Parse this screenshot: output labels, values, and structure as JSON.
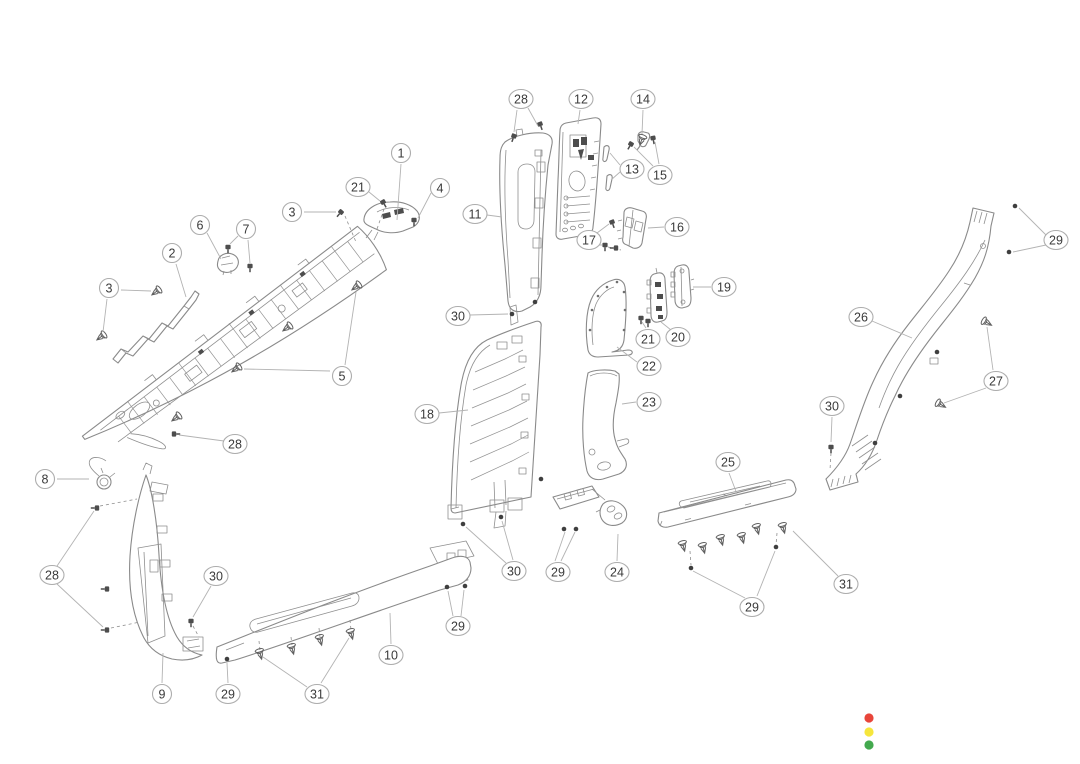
{
  "figure": {
    "background": "#ffffff",
    "line": "#8a8a8a",
    "leader": "#b3b3b3",
    "callout_fill": "#ffffff",
    "callout_stroke": "#adadad",
    "callout_text": "#3a3a3a"
  },
  "callouts": [
    {
      "label": "1",
      "x": 401,
      "y": 153,
      "leaders": [
        [
          [
            401,
            164
          ],
          [
            397,
            220
          ]
        ]
      ]
    },
    {
      "label": "21",
      "x": 358,
      "y": 187,
      "leaders": [
        [
          [
            369,
            192
          ],
          [
            380,
            201
          ]
        ]
      ]
    },
    {
      "label": "4",
      "x": 440,
      "y": 188,
      "leaders": [
        [
          [
            431,
            193
          ],
          [
            418,
            218
          ]
        ]
      ]
    },
    {
      "label": "3",
      "x": 292,
      "y": 212,
      "leaders": [
        [
          [
            304,
            212
          ],
          [
            336,
            212
          ]
        ]
      ]
    },
    {
      "label": "6",
      "x": 200,
      "y": 225,
      "leaders": [
        [
          [
            207,
            233
          ],
          [
            221,
            259
          ]
        ]
      ]
    },
    {
      "label": "7",
      "x": 246,
      "y": 229,
      "leaders": [
        [
          [
            238,
            236
          ],
          [
            230,
            244
          ]
        ],
        [
          [
            248,
            240
          ],
          [
            250,
            263
          ]
        ]
      ]
    },
    {
      "label": "2",
      "x": 172,
      "y": 253,
      "leaders": [
        [
          [
            176,
            264
          ],
          [
            186,
            297
          ]
        ]
      ]
    },
    {
      "label": "3",
      "x": 109,
      "y": 288,
      "leaders": [
        [
          [
            121,
            290
          ],
          [
            151,
            291
          ]
        ],
        [
          [
            107,
            299
          ],
          [
            103,
            332
          ]
        ]
      ]
    },
    {
      "label": "5",
      "x": 342,
      "y": 376,
      "leaders": [
        [
          [
            345,
            365
          ],
          [
            356,
            292
          ]
        ],
        [
          [
            330,
            371
          ],
          [
            244,
            369
          ]
        ]
      ]
    },
    {
      "label": "28",
      "x": 235,
      "y": 444,
      "leaders": [
        [
          [
            224,
            441
          ],
          [
            179,
            435
          ]
        ]
      ]
    },
    {
      "label": "8",
      "x": 45,
      "y": 479,
      "leaders": [
        [
          [
            57,
            479
          ],
          [
            89,
            479
          ]
        ]
      ]
    },
    {
      "label": "28",
      "x": 52,
      "y": 575,
      "leaders": [
        [
          [
            57,
            566
          ],
          [
            94,
            511
          ]
        ],
        [
          [
            57,
            584
          ],
          [
            103,
            627
          ]
        ]
      ]
    },
    {
      "label": "30",
      "x": 216,
      "y": 576,
      "leaders": [
        [
          [
            211,
            586
          ],
          [
            193,
            617
          ]
        ]
      ]
    },
    {
      "label": "9",
      "x": 162,
      "y": 694,
      "leaders": [
        [
          [
            162,
            683
          ],
          [
            163,
            653
          ]
        ]
      ]
    },
    {
      "label": "29",
      "x": 228,
      "y": 694,
      "leaders": [
        [
          [
            228,
            683
          ],
          [
            227,
            663
          ]
        ]
      ]
    },
    {
      "label": "31",
      "x": 317,
      "y": 694,
      "leaders": [
        [
          [
            307,
            687
          ],
          [
            263,
            657
          ]
        ],
        [
          [
            321,
            683
          ],
          [
            349,
            638
          ]
        ]
      ]
    },
    {
      "label": "10",
      "x": 391,
      "y": 655,
      "leaders": [
        [
          [
            391,
            644
          ],
          [
            390,
            613
          ]
        ]
      ]
    },
    {
      "label": "29",
      "x": 458,
      "y": 626,
      "leaders": [
        [
          [
            453,
            616
          ],
          [
            448,
            591
          ]
        ],
        [
          [
            461,
            616
          ],
          [
            464,
            590
          ]
        ]
      ]
    },
    {
      "label": "28",
      "x": 521,
      "y": 99,
      "leaders": [
        [
          [
            517,
            110
          ],
          [
            514,
            132
          ]
        ],
        [
          [
            528,
            108
          ],
          [
            538,
            126
          ]
        ]
      ]
    },
    {
      "label": "12",
      "x": 581,
      "y": 99,
      "leaders": [
        [
          [
            580,
            110
          ],
          [
            578,
            124
          ]
        ]
      ]
    },
    {
      "label": "14",
      "x": 643,
      "y": 99,
      "leaders": [
        [
          [
            643,
            110
          ],
          [
            642,
            134
          ]
        ]
      ]
    },
    {
      "label": "13",
      "x": 632,
      "y": 169,
      "leaders": [
        [
          [
            620,
            165
          ],
          [
            610,
            153
          ]
        ],
        [
          [
            620,
            172
          ],
          [
            611,
            180
          ]
        ]
      ]
    },
    {
      "label": "15",
      "x": 660,
      "y": 175,
      "leaders": [
        [
          [
            653,
            166
          ],
          [
            634,
            147
          ]
        ],
        [
          [
            659,
            164
          ],
          [
            655,
            142
          ]
        ]
      ]
    },
    {
      "label": "11",
      "x": 475,
      "y": 214,
      "leaders": [
        [
          [
            487,
            215
          ],
          [
            502,
            217
          ]
        ]
      ]
    },
    {
      "label": "17",
      "x": 589,
      "y": 240,
      "leaders": [
        [
          [
            597,
            233
          ],
          [
            609,
            224
          ]
        ],
        [
          [
            597,
            245
          ],
          [
            602,
            245
          ]
        ]
      ]
    },
    {
      "label": "16",
      "x": 677,
      "y": 227,
      "leaders": [
        [
          [
            664,
            227
          ],
          [
            648,
            228
          ]
        ]
      ]
    },
    {
      "label": "19",
      "x": 724,
      "y": 287,
      "leaders": [
        [
          [
            711,
            287
          ],
          [
            693,
            287
          ]
        ]
      ]
    },
    {
      "label": "21",
      "x": 648,
      "y": 339,
      "leaders": [
        [
          [
            646,
            328
          ],
          [
            642,
            322
          ]
        ]
      ]
    },
    {
      "label": "20",
      "x": 678,
      "y": 337,
      "leaders": [
        [
          [
            671,
            330
          ],
          [
            661,
            322
          ]
        ]
      ]
    },
    {
      "label": "22",
      "x": 649,
      "y": 366,
      "leaders": [
        [
          [
            637,
            362
          ],
          [
            617,
            347
          ]
        ]
      ]
    },
    {
      "label": "23",
      "x": 649,
      "y": 402,
      "leaders": [
        [
          [
            636,
            402
          ],
          [
            622,
            404
          ]
        ]
      ]
    },
    {
      "label": "30",
      "x": 458,
      "y": 316,
      "leaders": [
        [
          [
            470,
            315
          ],
          [
            508,
            314
          ]
        ]
      ]
    },
    {
      "label": "18",
      "x": 427,
      "y": 414,
      "leaders": [
        [
          [
            439,
            413
          ],
          [
            468,
            410
          ]
        ]
      ]
    },
    {
      "label": "30",
      "x": 514,
      "y": 571,
      "leaders": [
        [
          [
            506,
            563
          ],
          [
            466,
            527
          ]
        ],
        [
          [
            513,
            560
          ],
          [
            502,
            521
          ]
        ]
      ]
    },
    {
      "label": "29",
      "x": 558,
      "y": 572,
      "leaders": [
        [
          [
            555,
            561
          ],
          [
            565,
            532
          ]
        ],
        [
          [
            561,
            561
          ],
          [
            575,
            532
          ]
        ]
      ]
    },
    {
      "label": "24",
      "x": 617,
      "y": 572,
      "leaders": [
        [
          [
            617,
            561
          ],
          [
            618,
            534
          ]
        ]
      ]
    },
    {
      "label": "25",
      "x": 728,
      "y": 462,
      "leaders": [
        [
          [
            729,
            473
          ],
          [
            737,
            494
          ]
        ]
      ]
    },
    {
      "label": "31",
      "x": 846,
      "y": 584,
      "leaders": [
        [
          [
            838,
            576
          ],
          [
            793,
            531
          ]
        ]
      ]
    },
    {
      "label": "29",
      "x": 752,
      "y": 607,
      "leaders": [
        [
          [
            745,
            598
          ],
          [
            693,
            571
          ]
        ],
        [
          [
            757,
            596
          ],
          [
            775,
            551
          ]
        ]
      ]
    },
    {
      "label": "29",
      "x": 1056,
      "y": 240,
      "leaders": [
        [
          [
            1046,
            235
          ],
          [
            1019,
            208
          ]
        ],
        [
          [
            1046,
            245
          ],
          [
            1013,
            252
          ]
        ]
      ]
    },
    {
      "label": "26",
      "x": 861,
      "y": 317,
      "leaders": [
        [
          [
            872,
            321
          ],
          [
            912,
            338
          ]
        ]
      ]
    },
    {
      "label": "27",
      "x": 996,
      "y": 381,
      "leaders": [
        [
          [
            993,
            370
          ],
          [
            987,
            327
          ]
        ],
        [
          [
            986,
            388
          ],
          [
            944,
            403
          ]
        ]
      ]
    },
    {
      "label": "30",
      "x": 832,
      "y": 406,
      "leaders": [
        [
          [
            832,
            417
          ],
          [
            831,
            442
          ]
        ]
      ]
    }
  ],
  "fasteners": [
    {
      "t": "screw",
      "x": 383,
      "y": 202,
      "r": -30
    },
    {
      "t": "screw",
      "x": 414,
      "y": 220,
      "r": 0
    },
    {
      "t": "screw",
      "x": 341,
      "y": 212,
      "r": 40
    },
    {
      "t": "screw",
      "x": 228,
      "y": 247,
      "r": 0
    },
    {
      "t": "screw",
      "x": 250,
      "y": 266,
      "r": 0
    },
    {
      "t": "screw",
      "x": 174,
      "y": 434,
      "r": -90
    },
    {
      "t": "screw",
      "x": 97,
      "y": 508,
      "r": 90
    },
    {
      "t": "screw",
      "x": 107,
      "y": 589,
      "r": 90
    },
    {
      "t": "screw",
      "x": 107,
      "y": 630,
      "r": 90
    },
    {
      "t": "screw",
      "x": 191,
      "y": 621,
      "r": 0
    },
    {
      "t": "screw",
      "x": 514,
      "y": 136,
      "r": 20
    },
    {
      "t": "screw",
      "x": 540,
      "y": 124,
      "r": -20
    },
    {
      "t": "screw",
      "x": 631,
      "y": 144,
      "r": 30
    },
    {
      "t": "screw",
      "x": 653,
      "y": 138,
      "r": -10
    },
    {
      "t": "screw",
      "x": 612,
      "y": 222,
      "r": -20
    },
    {
      "t": "screw",
      "x": 605,
      "y": 245,
      "r": 0
    },
    {
      "t": "screw",
      "x": 616,
      "y": 248,
      "r": 90
    },
    {
      "t": "screw",
      "x": 641,
      "y": 318,
      "r": 0
    },
    {
      "t": "screw",
      "x": 648,
      "y": 321,
      "r": 0
    },
    {
      "t": "screw",
      "x": 831,
      "y": 447,
      "r": 0
    },
    {
      "t": "dot",
      "x": 227,
      "y": 659,
      "r": 0
    },
    {
      "t": "dot",
      "x": 447,
      "y": 587,
      "r": 0
    },
    {
      "t": "dot",
      "x": 465,
      "y": 586,
      "r": 0
    },
    {
      "t": "dot",
      "x": 564,
      "y": 529,
      "r": 0
    },
    {
      "t": "dot",
      "x": 576,
      "y": 529,
      "r": 0
    },
    {
      "t": "dot",
      "x": 691,
      "y": 568,
      "r": 0
    },
    {
      "t": "dot",
      "x": 776,
      "y": 547,
      "r": 0
    },
    {
      "t": "dot",
      "x": 1015,
      "y": 206,
      "r": 0
    },
    {
      "t": "dot",
      "x": 1009,
      "y": 252,
      "r": 0
    },
    {
      "t": "dot",
      "x": 535,
      "y": 302,
      "r": 0
    },
    {
      "t": "dot",
      "x": 541,
      "y": 479,
      "r": 0
    },
    {
      "t": "dot",
      "x": 937,
      "y": 352,
      "r": 0
    },
    {
      "t": "dot",
      "x": 900,
      "y": 396,
      "r": 0
    },
    {
      "t": "dot",
      "x": 875,
      "y": 443,
      "r": 0
    },
    {
      "t": "dot",
      "x": 512,
      "y": 314,
      "r": 0
    },
    {
      "t": "dot",
      "x": 463,
      "y": 524,
      "r": 0
    },
    {
      "t": "dot",
      "x": 501,
      "y": 517,
      "r": 0
    },
    {
      "t": "clip",
      "x": 157,
      "y": 291,
      "r": 53
    },
    {
      "t": "clip",
      "x": 102,
      "y": 336,
      "r": 53
    },
    {
      "t": "clip",
      "x": 288,
      "y": 327,
      "r": 53
    },
    {
      "t": "clip",
      "x": 357,
      "y": 286,
      "r": 53
    },
    {
      "t": "clip",
      "x": 237,
      "y": 368,
      "r": 53
    },
    {
      "t": "clip",
      "x": 177,
      "y": 417,
      "r": 53
    },
    {
      "t": "clip",
      "x": 260,
      "y": 653,
      "r": -15
    },
    {
      "t": "clip",
      "x": 292,
      "y": 648,
      "r": -15
    },
    {
      "t": "clip",
      "x": 320,
      "y": 639,
      "r": -15
    },
    {
      "t": "clip",
      "x": 351,
      "y": 633,
      "r": -15
    },
    {
      "t": "clip",
      "x": 683,
      "y": 545,
      "r": -15
    },
    {
      "t": "clip",
      "x": 703,
      "y": 547,
      "r": -15
    },
    {
      "t": "clip",
      "x": 721,
      "y": 539,
      "r": -15
    },
    {
      "t": "clip",
      "x": 742,
      "y": 537,
      "r": -15
    },
    {
      "t": "clip",
      "x": 757,
      "y": 528,
      "r": -15
    },
    {
      "t": "clip",
      "x": 783,
      "y": 527,
      "r": -15
    },
    {
      "t": "clip",
      "x": 986,
      "y": 322,
      "r": -60
    },
    {
      "t": "clip",
      "x": 940,
      "y": 404,
      "r": -60
    },
    {
      "t": "clip",
      "x": 642,
      "y": 139,
      "r": 20
    }
  ],
  "dashed_lines": [
    [
      345,
      216,
      356,
      242
    ],
    [
      384,
      209,
      377,
      229
    ],
    [
      100,
      506,
      137,
      499
    ],
    [
      111,
      628,
      140,
      622
    ],
    [
      193,
      626,
      199,
      637
    ],
    [
      259,
      641,
      260,
      650
    ],
    [
      291,
      637,
      292,
      645
    ],
    [
      319,
      628,
      320,
      637
    ],
    [
      350,
      620,
      351,
      630
    ],
    [
      690,
      551,
      691,
      565
    ],
    [
      777,
      533,
      776,
      545
    ],
    [
      831,
      453,
      830,
      470
    ],
    [
      608,
      247,
      621,
      250
    ]
  ],
  "status_indicator": {
    "cx": 869,
    "r": 4.6,
    "lights": [
      {
        "name": "red-light",
        "color": "#e8453a",
        "cy": 718
      },
      {
        "name": "yellow-light",
        "color": "#f6e63c",
        "cy": 732
      },
      {
        "name": "green-light",
        "color": "#43a94e",
        "cy": 745
      }
    ]
  }
}
